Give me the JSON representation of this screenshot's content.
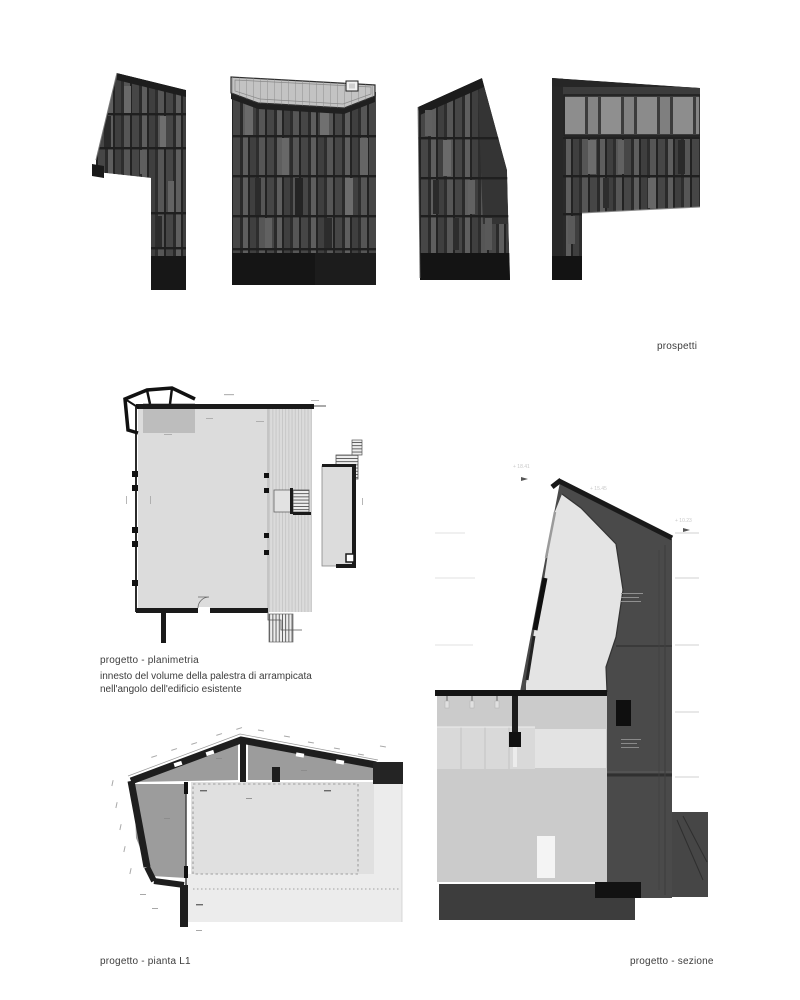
{
  "board": {
    "background": "#ffffff"
  },
  "labels": {
    "prospetti": "prospetti",
    "planimetria_title": "progetto - planimetria",
    "planimetria_caption1": "innesto del volume della palestra di arrampicata",
    "planimetria_caption2": "nell'angolo dell'edificio esistente",
    "pianta_l1": "progetto - pianta L1",
    "sezione": "progetto - sezione"
  },
  "drawings": {
    "section": {
      "levels": [
        "+ 18.41",
        "+ 15.45",
        "+ 10.23"
      ]
    }
  },
  "colors": {
    "facade_dark": "#3b3b3b",
    "facade_panel_light": "#6b6b6b",
    "facade_base": "#151515",
    "roof_light": "#c3c3c3",
    "plan_floor": "#dcdcdc",
    "plan_wall": "#1a1a1a",
    "plan_room_gray": "#9c9c9c",
    "section_wall": "#4a4a4a",
    "section_interior": "#e4e4e4",
    "ground": "#3d3d3d"
  }
}
